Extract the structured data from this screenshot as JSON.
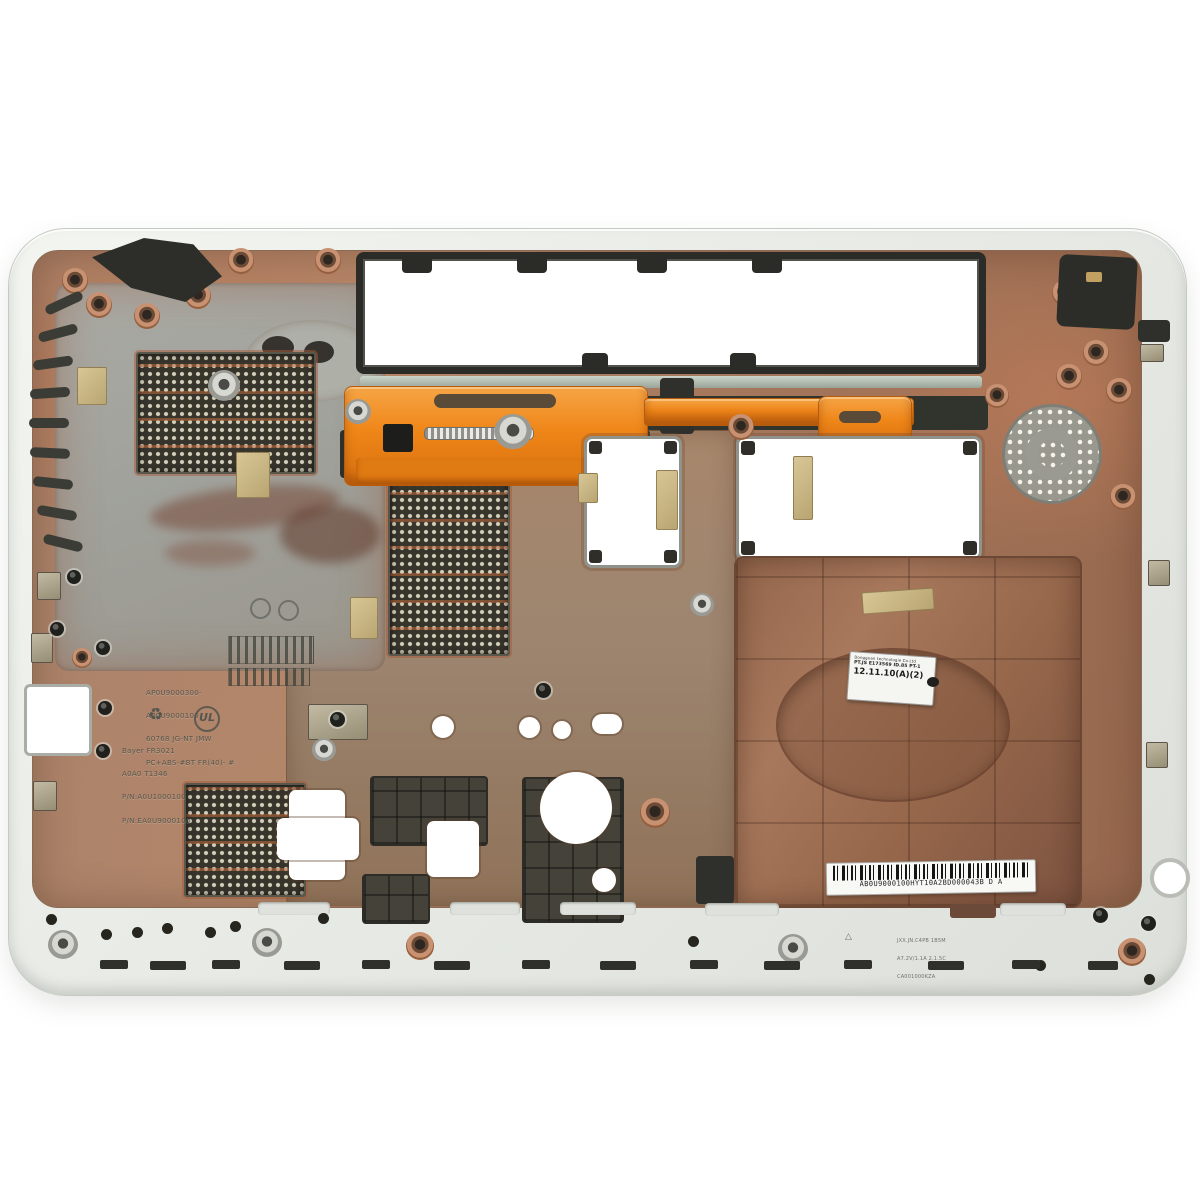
{
  "meta": {
    "description": "Product photograph: bottom base enclosure of a laptop (inside view), white plastic shell with copper EMI shielding, orange battery latch, vents, speaker grille and HDD bay",
    "background_color": "#ffffff"
  },
  "colors": {
    "shell_white": "#edefeb",
    "copper": "#a97a5e",
    "grey_panel": "#a2a39d",
    "dark_plastic": "#2b2c27",
    "orange_latch": "#ef8618",
    "kapton_tape": "#cdbd8e"
  },
  "labels": {
    "spec_label": {
      "line1": "Dongguan technologie Co.Ltd",
      "line2": "PT.JS E173569 ID.85 PT-1",
      "line3": "12.11.10(A)(2)"
    },
    "barcode_label": {
      "code": "AB0U9000100HYT10A2BD000043B D A"
    }
  },
  "molded_text": {
    "block1_lines": [
      "AP0U9000300-",
      "AP0U9000100",
      "60768 JG-NT JMW",
      "PC+ABS-#BT FR(40)- #"
    ],
    "block2_lines": [
      "Bayer FR3021",
      "A0A0 T1346",
      "P/N:A0U1000100",
      "P/N:EA0U9000100"
    ],
    "recycle_symbol": "♻",
    "ul_mark": "UL",
    "bottom_lines": [
      "JXX.JN.C4PB 1B5M",
      "A7.2V/1.1A 2.1.5C",
      "CA001000KZA"
    ],
    "bottom_mark": "△"
  }
}
